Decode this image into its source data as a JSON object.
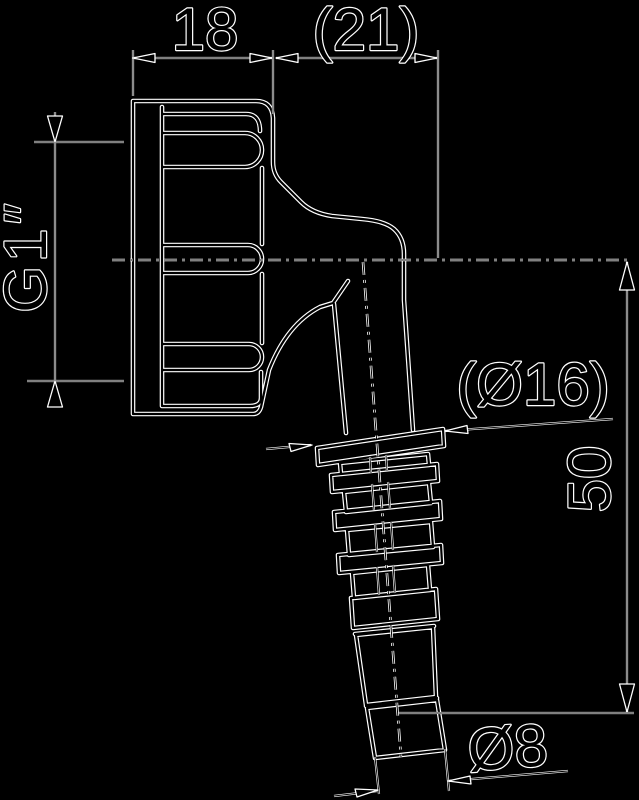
{
  "drawing": {
    "kind": "dimensioned technical line drawing",
    "labels": {
      "width_top_left": "18",
      "width_top_right": "(21)",
      "thread_size": "G1″",
      "flange_diameter": "(Ø16)",
      "outlet_length": "50",
      "tip_diameter": "Ø8"
    },
    "colors": {
      "background": "#000000",
      "line_halo": "#ffffff",
      "line_core": "#000000"
    }
  }
}
